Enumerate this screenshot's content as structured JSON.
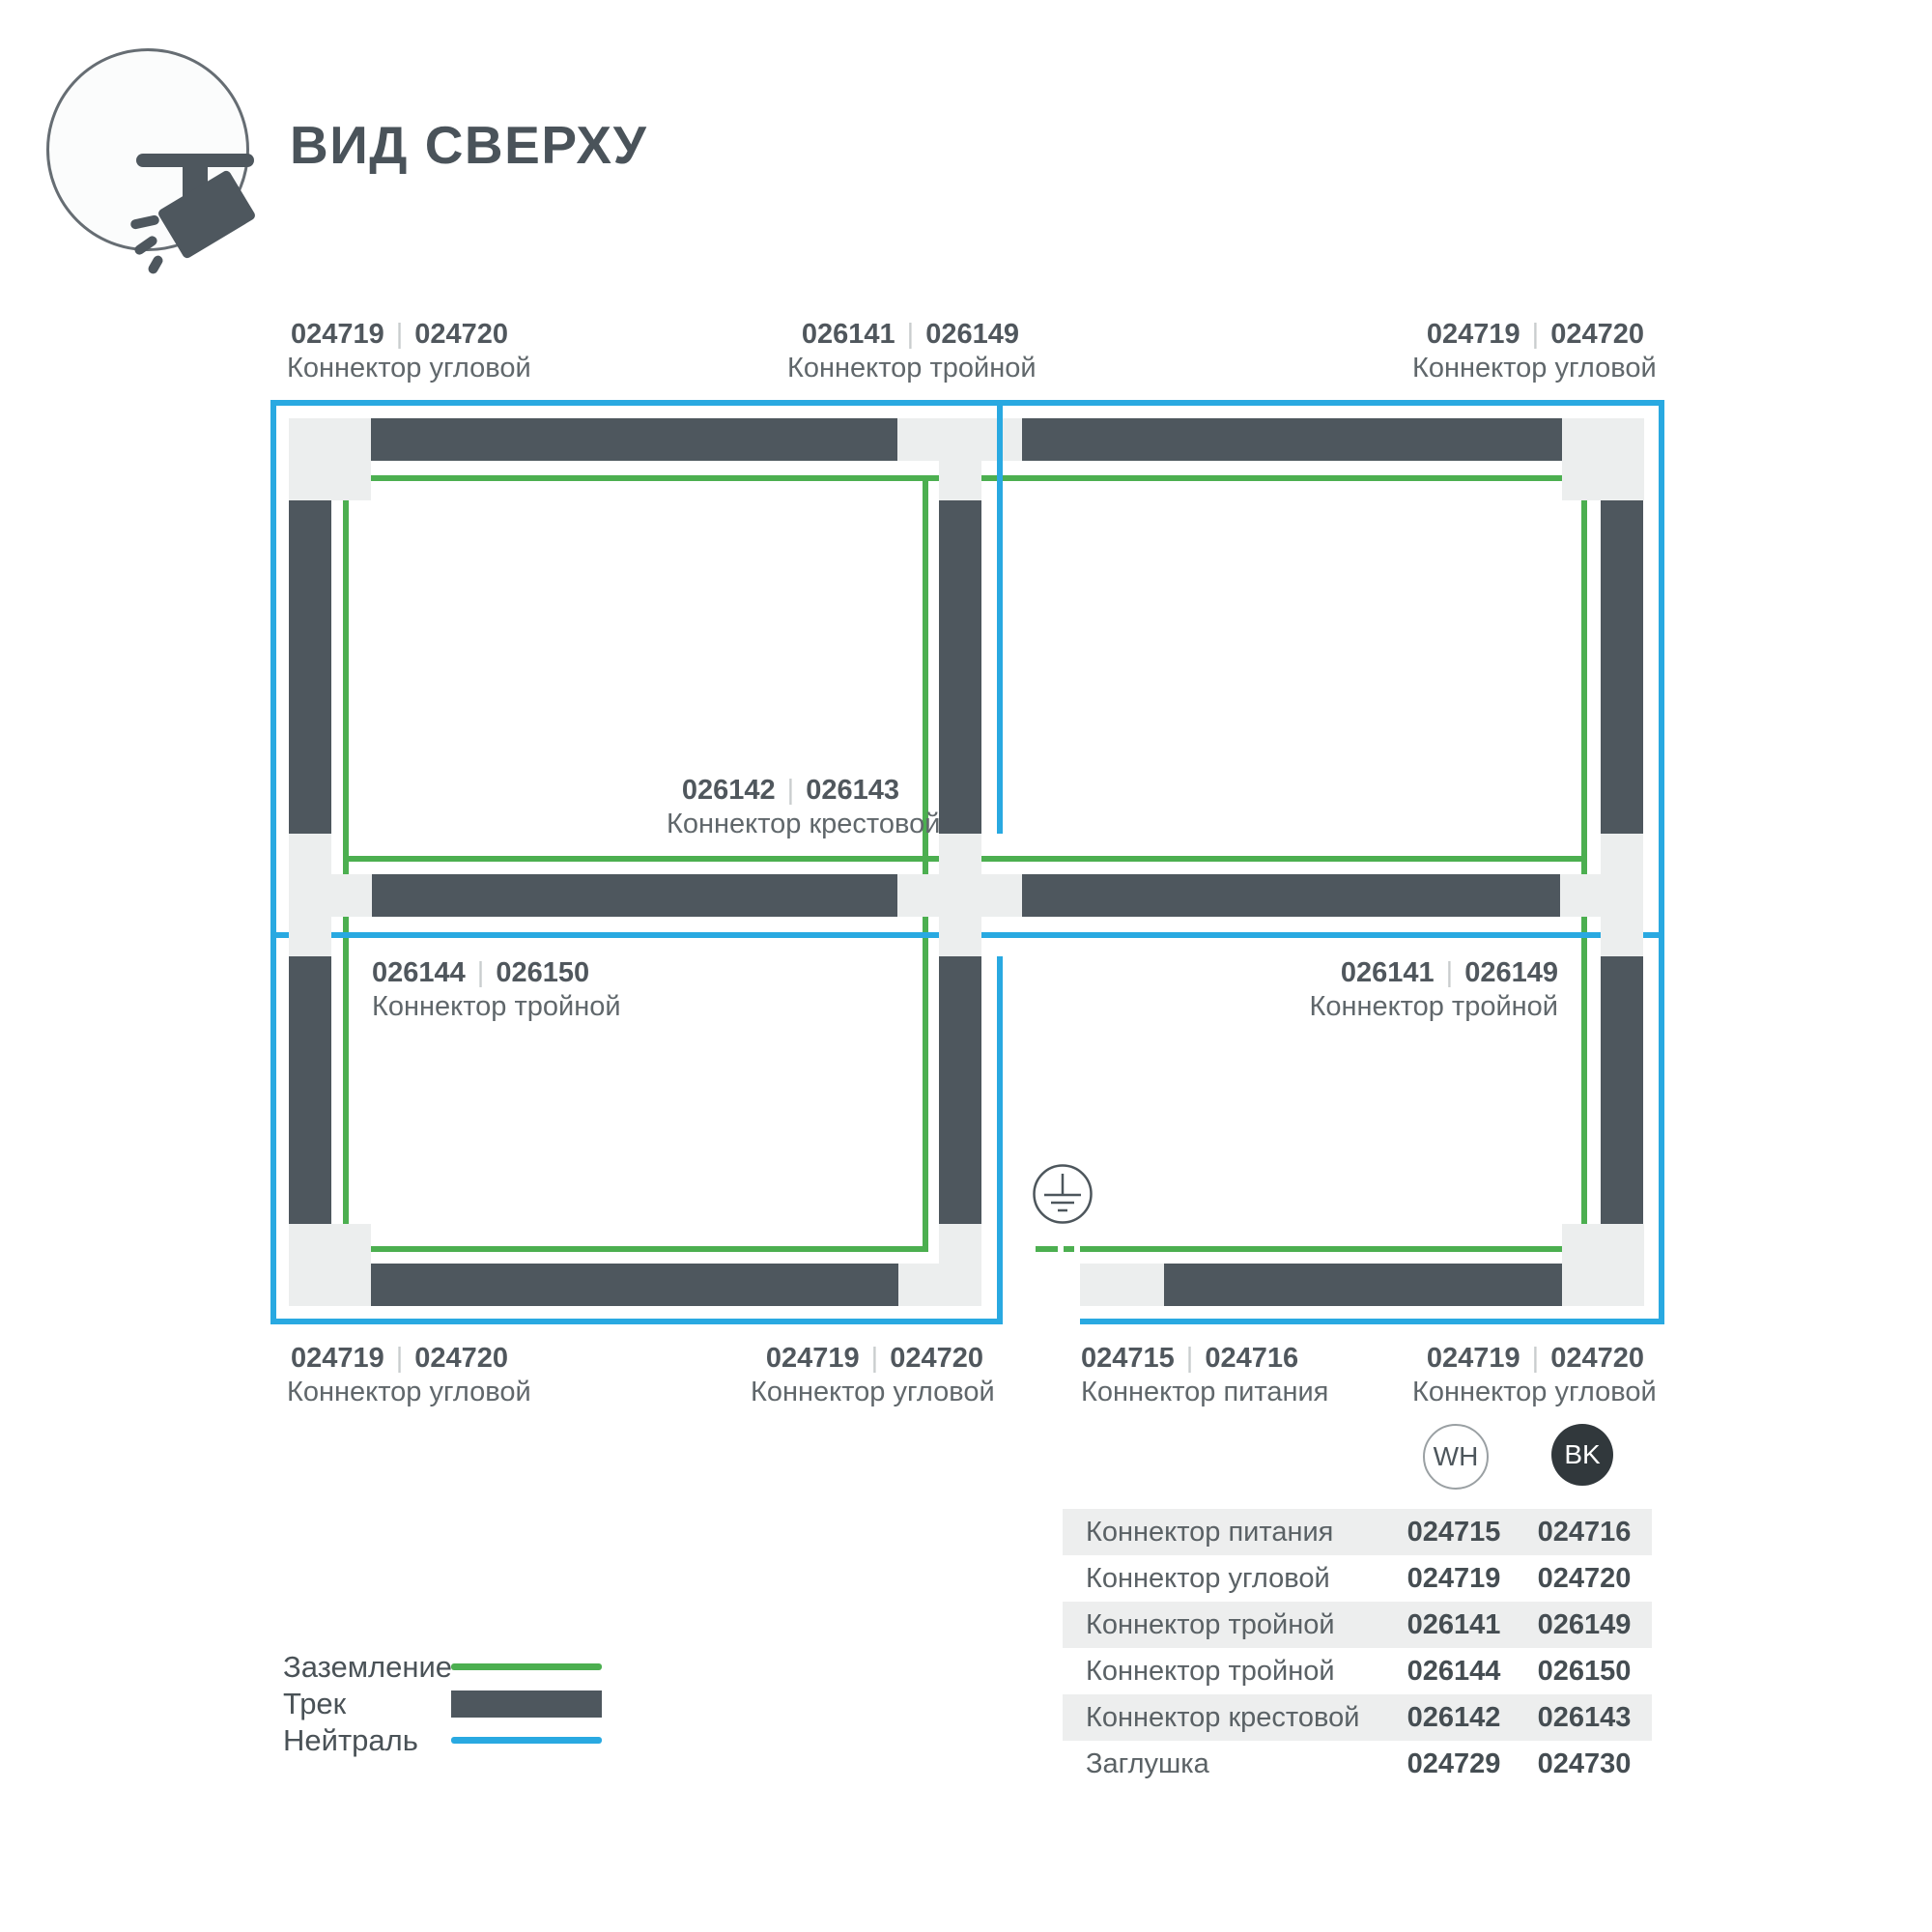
{
  "ui": {
    "separator": "|"
  },
  "header": {
    "title": "ВИД СВЕРХУ",
    "icon": "track-spotlight-icon"
  },
  "callouts": [
    {
      "wh": "024719",
      "bk": "024720",
      "name": "Коннектор угловой",
      "position": "top-left"
    },
    {
      "wh": "026141",
      "bk": "026149",
      "name": "Коннектор тройной",
      "position": "top-center"
    },
    {
      "wh": "024719",
      "bk": "024720",
      "name": "Коннектор угловой",
      "position": "top-right"
    },
    {
      "wh": "026142",
      "bk": "026143",
      "name": "Коннектор крестовой",
      "position": "center"
    },
    {
      "wh": "026144",
      "bk": "026150",
      "name": "Коннектор тройной",
      "position": "middle-left"
    },
    {
      "wh": "026141",
      "bk": "026149",
      "name": "Коннектор тройной",
      "position": "middle-right"
    },
    {
      "wh": "024719",
      "bk": "024720",
      "name": "Коннектор угловой",
      "position": "bottom-left"
    },
    {
      "wh": "024719",
      "bk": "024720",
      "name": "Коннектор угловой",
      "position": "bottom-center"
    },
    {
      "wh": "024715",
      "bk": "024716",
      "name": "Коннектор питания",
      "position": "bottom-power"
    },
    {
      "wh": "024719",
      "bk": "024720",
      "name": "Коннектор угловой",
      "position": "bottom-right"
    }
  ],
  "legend": {
    "items": [
      {
        "label": "Заземление",
        "swatch": "ground-line",
        "color": "#4caf50"
      },
      {
        "label": "Трек",
        "swatch": "track-bar",
        "color": "#4e575e"
      },
      {
        "label": "Нейтраль",
        "swatch": "neutral-line",
        "color": "#29a9e1"
      }
    ]
  },
  "table": {
    "columns": [
      {
        "id": "wh",
        "label": "WH"
      },
      {
        "id": "bk",
        "label": "BK"
      }
    ],
    "rows": [
      {
        "name": "Коннектор питания",
        "wh": "024715",
        "bk": "024716"
      },
      {
        "name": "Коннектор угловой",
        "wh": "024719",
        "bk": "024720"
      },
      {
        "name": "Коннектор тройной",
        "wh": "026141",
        "bk": "026149"
      },
      {
        "name": "Коннектор тройной",
        "wh": "026144",
        "bk": "026150"
      },
      {
        "name": "Коннектор крестовой",
        "wh": "026142",
        "bk": "026143"
      },
      {
        "name": "Заглушка",
        "wh": "024729",
        "bk": "024730"
      }
    ]
  },
  "colors": {
    "ground": "#4caf50",
    "neutral": "#29a9e1",
    "track": "#4e575e",
    "connector": "#eceeee",
    "text": "#4d565c",
    "table_stripe": "#edeeee",
    "bk_badge": "#31383c"
  }
}
